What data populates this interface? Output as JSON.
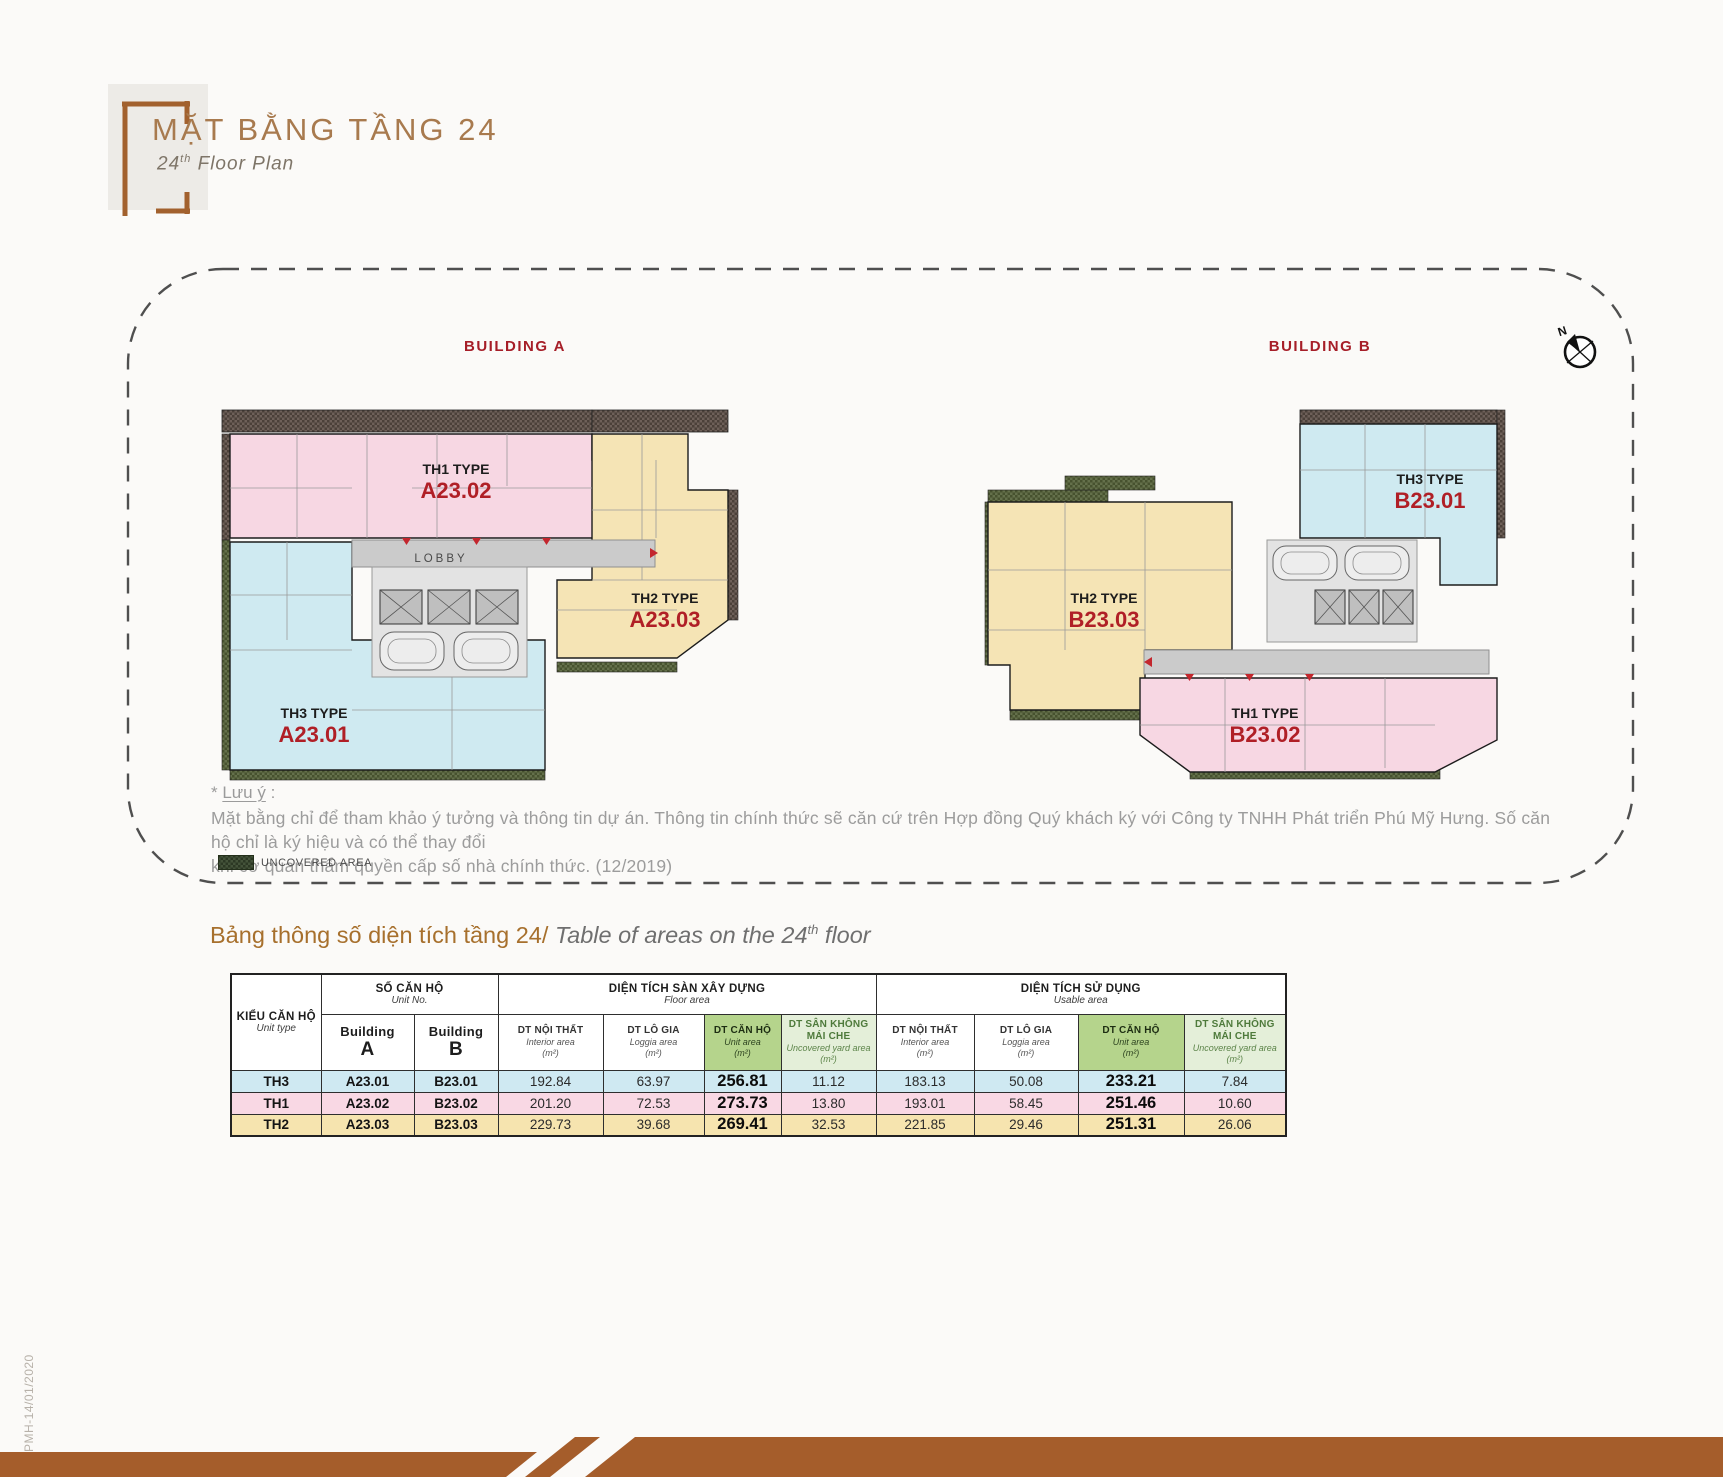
{
  "header": {
    "title": "MẶT BẰNG TẦNG 24",
    "subtitle_num": "24",
    "subtitle_sup": "th",
    "subtitle_rest": " Floor Plan"
  },
  "plan": {
    "building_a": {
      "label": "BUILDING A",
      "lobby": "LOBBY",
      "units": [
        {
          "type": "TH1 TYPE",
          "no": "A23.02"
        },
        {
          "type": "TH2 TYPE",
          "no": "A23.03"
        },
        {
          "type": "TH3 TYPE",
          "no": "A23.01"
        }
      ]
    },
    "building_b": {
      "label": "BUILDING B",
      "units": [
        {
          "type": "TH3 TYPE",
          "no": "B23.01"
        },
        {
          "type": "TH2 TYPE",
          "no": "B23.03"
        },
        {
          "type": "TH1 TYPE",
          "no": "B23.02"
        }
      ]
    },
    "compass_n": "N",
    "note_star": "* ",
    "note_label": "Lưu ý",
    "note_colon": " :",
    "note_line1": "Mặt bằng chỉ để tham khảo ý tưởng và thông tin dự án. Thông tin chính thức sẽ căn cứ trên Hợp đồng Quý khách ký với Công ty TNHH Phát triển Phú Mỹ Hưng. Số căn hộ chỉ là ký hiệu và có thể thay đổi",
    "note_line2": "khi cơ quan thẩm quyền cấp số nhà chính thức. (12/2019)",
    "legend_label": "UNCOVERED AREA"
  },
  "table": {
    "title_vn": "Bảng thông số diện tích tầng 24/ ",
    "title_en_pre": "Table of areas on the 24",
    "title_en_sup": "th",
    "title_en_post": " floor",
    "cols": {
      "unit_type": {
        "vn": "KIỂU CĂN HỘ",
        "en": "Unit type"
      },
      "unit_no": {
        "vn": "SỐ CĂN HỘ",
        "en": "Unit No."
      },
      "building_a": {
        "word": "Building",
        "letter": "A"
      },
      "building_b": {
        "word": "Building",
        "letter": "B"
      },
      "floor_area": {
        "vn": "DIỆN TÍCH SÀN XÂY DỰNG",
        "en": "Floor area"
      },
      "usable_area": {
        "vn": "DIỆN TÍCH SỬ DỤNG",
        "en": "Usable area"
      },
      "interior": {
        "vn": "DT NỘI THẤT",
        "en": "Interior area",
        "unit": "(m²)"
      },
      "loggia": {
        "vn": "DT LÔ GIA",
        "en": "Loggia area",
        "unit": "(m²)"
      },
      "unit_area": {
        "vn": "DT CĂN HỘ",
        "en": "Unit area",
        "unit": "(m²)"
      },
      "yard": {
        "vn": "DT SÂN KHÔNG MÁI CHE",
        "en": "Uncovered yard area (m²)"
      }
    },
    "rows": [
      {
        "type": "TH3",
        "a": "A23.01",
        "b": "B23.01",
        "f_int": "192.84",
        "f_log": "63.97",
        "f_unit": "256.81",
        "f_yard": "11.12",
        "u_int": "183.13",
        "u_log": "50.08",
        "u_unit": "233.21",
        "u_yard": "7.84"
      },
      {
        "type": "TH1",
        "a": "A23.02",
        "b": "B23.02",
        "f_int": "201.20",
        "f_log": "72.53",
        "f_unit": "273.73",
        "f_yard": "13.80",
        "u_int": "193.01",
        "u_log": "58.45",
        "u_unit": "251.46",
        "u_yard": "10.60"
      },
      {
        "type": "TH2",
        "a": "A23.03",
        "b": "B23.03",
        "f_int": "229.73",
        "f_log": "39.68",
        "f_unit": "269.41",
        "f_yard": "32.53",
        "u_int": "221.85",
        "u_log": "29.46",
        "u_unit": "251.31",
        "u_yard": "26.06"
      }
    ]
  },
  "footer": {
    "code": "PMH-14/01/2020"
  },
  "colors": {
    "accent_brown": "#a55d2b",
    "title_brown": "#a87a4e",
    "building_red": "#a61e28",
    "unit_no_red": "#b01f26",
    "unit_pink": "#f7d7e3",
    "unit_blue": "#cfeaf1",
    "unit_yellow": "#f5e4b5",
    "corridor_gray": "#cbcbcb",
    "hatch_dark": "#6e6059",
    "hatch_olive": "#64704b",
    "table_green": "#b5d48c",
    "table_pale_green": "#e4efd9",
    "row_th3": "#cfe9f2",
    "row_th1": "#f9d8e4",
    "row_th2": "#f6e4af"
  }
}
